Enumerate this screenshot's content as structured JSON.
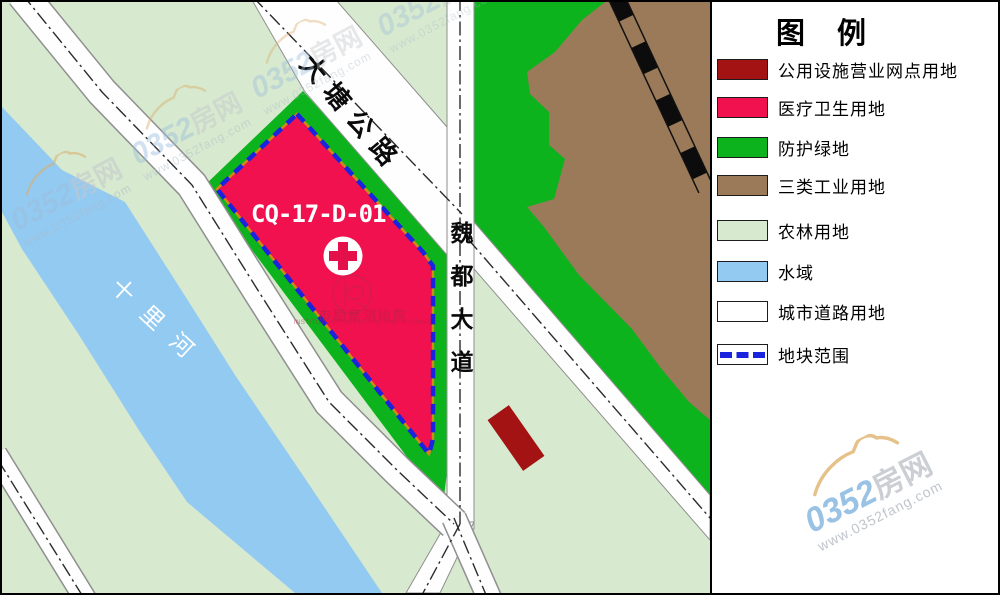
{
  "map": {
    "parcel": {
      "code": "CQ-17-D-01",
      "fill": "#F0114E",
      "boundary_color": "#1A23DE"
    },
    "roads": {
      "datang": "大塘公路",
      "weidu": "魏都大道"
    },
    "river": {
      "name": "十里河"
    },
    "seal": {
      "cn": "市勘察测绘院",
      "en": "INSTITUTE OF SURVEYING AND MAPPING"
    }
  },
  "legend": {
    "title": "图 例",
    "items": [
      {
        "label": "公用设施营业网点用地",
        "color": "#A31313",
        "style": "fill"
      },
      {
        "label": "医疗卫生用地",
        "color": "#F0114E",
        "style": "fill"
      },
      {
        "label": "防护绿地",
        "color": "#0DB31C",
        "style": "fill"
      },
      {
        "label": "三类工业用地",
        "color": "#9A7A59",
        "style": "fill"
      },
      {
        "label": "农林用地",
        "color": "#D7E9CF",
        "style": "fill"
      },
      {
        "label": "水域",
        "color": "#93CAF2",
        "style": "fill"
      },
      {
        "label": "城市道路用地",
        "color": "#FFFFFF",
        "style": "fill"
      },
      {
        "label": "地块范围",
        "color": "#1A23DE",
        "style": "dashed"
      }
    ]
  },
  "watermark": {
    "brand_num": "0352",
    "brand_cn": "房网",
    "url": "www.0352fang.com"
  }
}
